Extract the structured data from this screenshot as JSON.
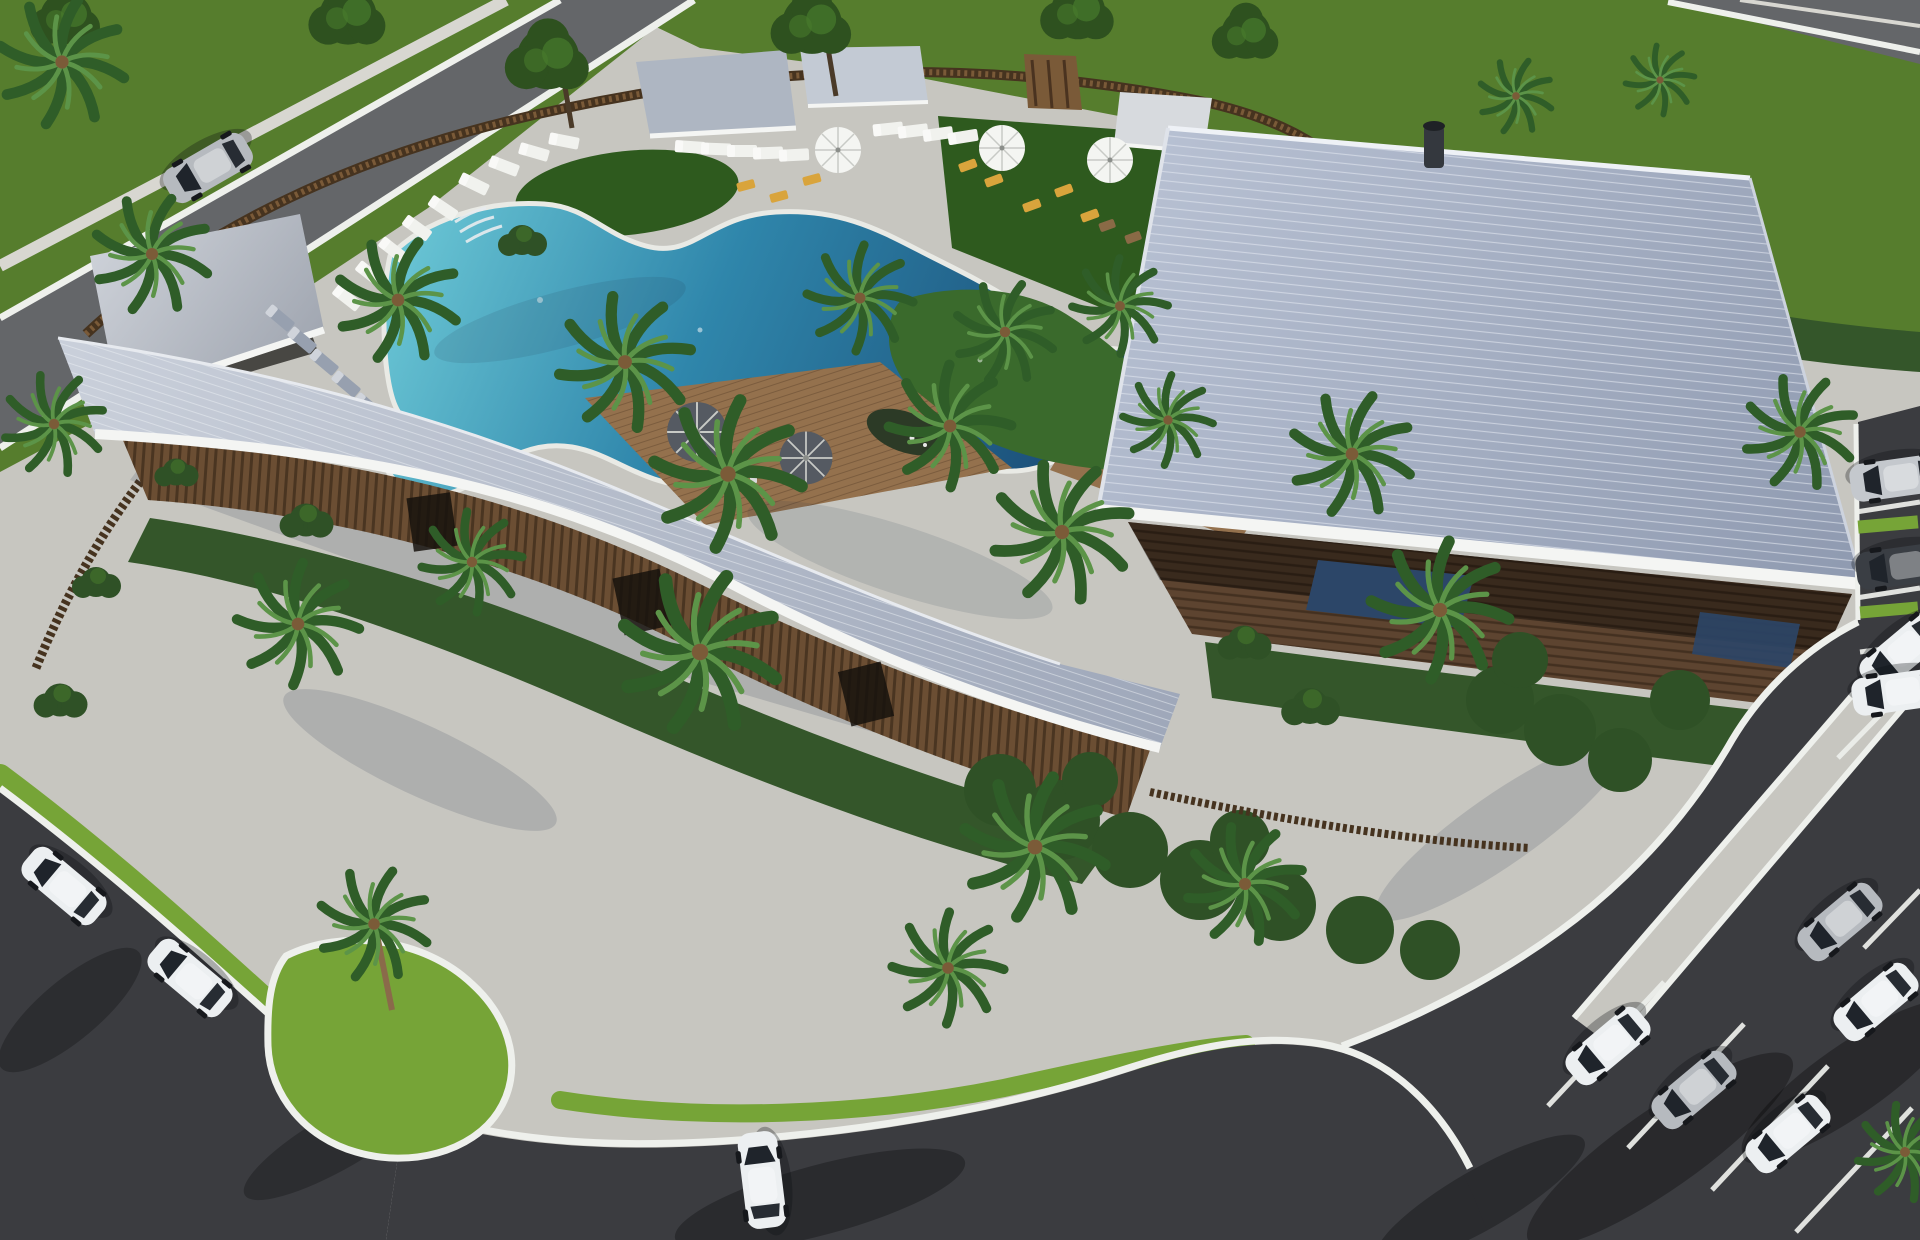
{
  "scene": {
    "type": "aerial-architectural-rendering",
    "description": "Aerial 3D rendering of a resort clubhouse amenity center: freeform lagoon pool with planted island, curved wood-slat building with sweeping metal roof, large rectangular clubhouse with standing-seam roof, poolside cabanas, loungers and umbrellas, palm trees, perimeter streets and parking lots with white cars.",
    "objects": {
      "buildings": 2,
      "poolside_pavilions": 4,
      "swimming_pools": 1,
      "cars": 13,
      "palm_trees": 25,
      "white_loungers": 18,
      "blue_loungers": 5,
      "yellow_loungers": 8,
      "white_umbrellas": 3,
      "dark_umbrellas": 2,
      "parking_lots": 2
    }
  },
  "colors": {
    "paver": "#c7c6c0",
    "paverShade": "#a9adb2",
    "asphaltRoad": "#646669",
    "asphaltLot": "#3b3c40",
    "curb": "#eef0ec",
    "sidewalk": "#d8d7d1",
    "grassField": "#567d2d",
    "grassBright": "#76a437",
    "lawnCourtyard": "#2e5a1e",
    "hedge": "#34562a",
    "shrubDark": "#2f5126",
    "treeCanopy": "#2e511f",
    "palmFrond": "#2f5d28",
    "palmFrondLight": "#5c9448",
    "trunk": "#8a6a4a",
    "fenceWood": "#46331f",
    "fenceWoodLight": "#7a5a38",
    "slatWall": "#6b4e33",
    "slatWallDark": "#5d4430",
    "deckWood": "#94714d",
    "roofMetal": "#8f9ab0",
    "roofMetalLight": "#b7c0d2",
    "roofCurved": "#9fa8ba",
    "roofCurvedLight": "#c9cfda",
    "pavilionRoof": "#aeb6c2",
    "fascia": "#f4f5f3",
    "poolShallow": "#6cc8d6",
    "poolMid": "#2f86ab",
    "poolDeep": "#16406b",
    "glassTint": "#2c4668",
    "umbrellaWhite": "#f4f5f2",
    "umbrellaDark": "#555a62",
    "loungerWhite": "#f1f2ee",
    "loungerBlue": "#97a0af",
    "chairYellow": "#d9a43c",
    "carWhite": "#eceff1",
    "carSilver": "#b6babf",
    "carSilverSuv": "#c4c8cd",
    "carDark": "#3a3e44",
    "islandGreen": "#3a6a2c",
    "shadow": "#0a0c10"
  }
}
